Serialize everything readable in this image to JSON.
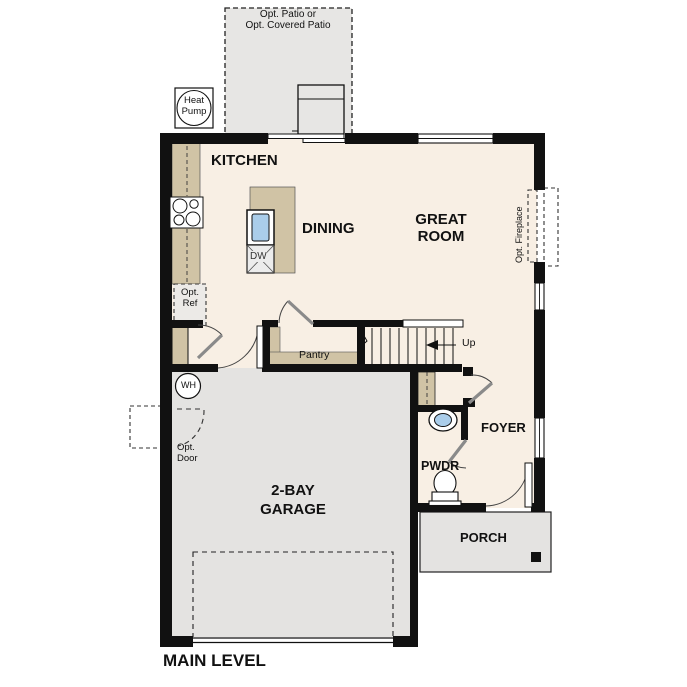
{
  "plan_title": "MAIN LEVEL",
  "colors": {
    "wall": "#111111",
    "floor": "#f8efe4",
    "concrete": "#e4e3e1",
    "casework": "#d0c3a5",
    "water_fixture": "#aacdea"
  },
  "outdoor": {
    "patio_label_line1": "Opt. Patio or",
    "patio_label_line2": "Opt. Covered Patio",
    "heat_pump_line1": "Heat",
    "heat_pump_line2": "Pump",
    "porch_label": "PORCH"
  },
  "rooms": {
    "kitchen": "KITCHEN",
    "dining": "DINING",
    "great_room_line1": "GREAT",
    "great_room_line2": "ROOM",
    "foyer": "FOYER",
    "powder": "PWDR",
    "garage_line1": "2-BAY",
    "garage_line2": "GARAGE"
  },
  "features": {
    "pantry": "Pantry",
    "stairs_up": "Up",
    "water_heater": "WH",
    "dishwasher": "DW",
    "opt_ref_line1": "Opt.",
    "opt_ref_line2": "Ref",
    "opt_door_line1": "Opt.",
    "opt_door_line2": "Door",
    "opt_fireplace": "Opt. Fireplace"
  }
}
